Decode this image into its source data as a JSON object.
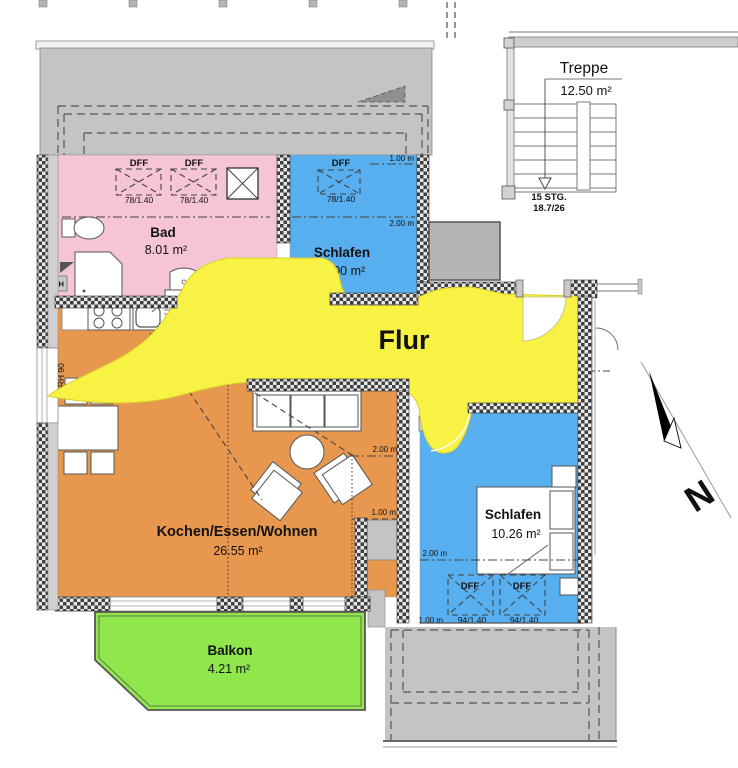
{
  "colors": {
    "bad": "#F5C4D7",
    "schlafen": "#57AFF0",
    "flur": "#F7F244",
    "wohnen": "#E8984E",
    "balkon": "#90E74C",
    "roof": "#C4C4C4",
    "shaft": "#B5B5B5"
  },
  "rooms": {
    "bad": {
      "name": "Bad",
      "area": "8.01 m²"
    },
    "schlafen_klein": {
      "name": "Schlafen",
      "area": "5.00 m²"
    },
    "flur": {
      "name": "Flur"
    },
    "wohnen": {
      "name": "Kochen/Essen/Wohnen",
      "area": "26.55 m²"
    },
    "balkon": {
      "name": "Balkon",
      "area": "4.21 m²"
    },
    "schlafen_gross": {
      "name": "Schlafen",
      "area": "10.26 m²"
    },
    "treppe": {
      "name": "Treppe",
      "area": "12.50 m²"
    }
  },
  "stairs": {
    "count": "15 STG.",
    "step": "18.7/26"
  },
  "skylight": {
    "label": "DFF",
    "size_small": "78/1.40",
    "size_large": "94/1.40"
  },
  "measure": {
    "one": "1.00 m",
    "two": "2.00 m"
  },
  "labels": {
    "sill": "BRH 90",
    "rh": "RH",
    "north": "N"
  }
}
